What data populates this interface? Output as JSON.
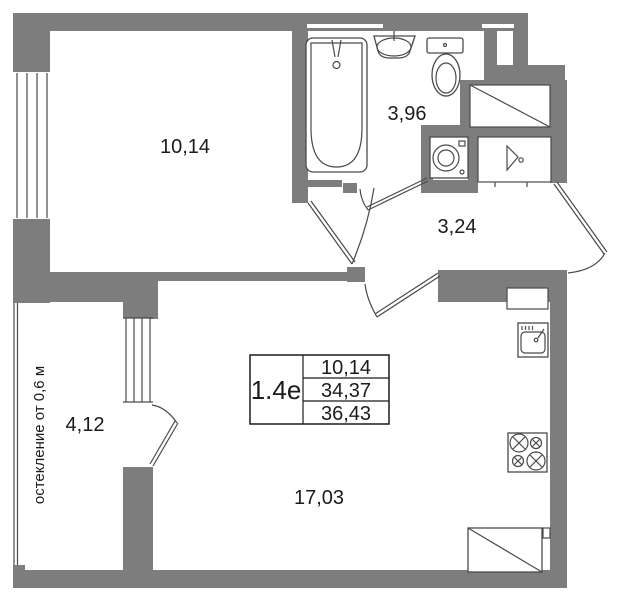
{
  "plan": {
    "unit": {
      "label": "1.4е"
    },
    "area_table": {
      "living_area": "10,14",
      "apartment_area": "34,37",
      "total_area": "36,43"
    },
    "rooms": {
      "bedroom": "10,14",
      "bathroom": "3,96",
      "hallway": "3,24",
      "balcony": "4,12",
      "living_kitchen": "17,03"
    },
    "notes": {
      "glazing": "остекление от 0,6 м"
    },
    "colors": {
      "wall": "#7d7d7d",
      "line": "#4a4a4a",
      "text": "#1b1b1b"
    }
  }
}
